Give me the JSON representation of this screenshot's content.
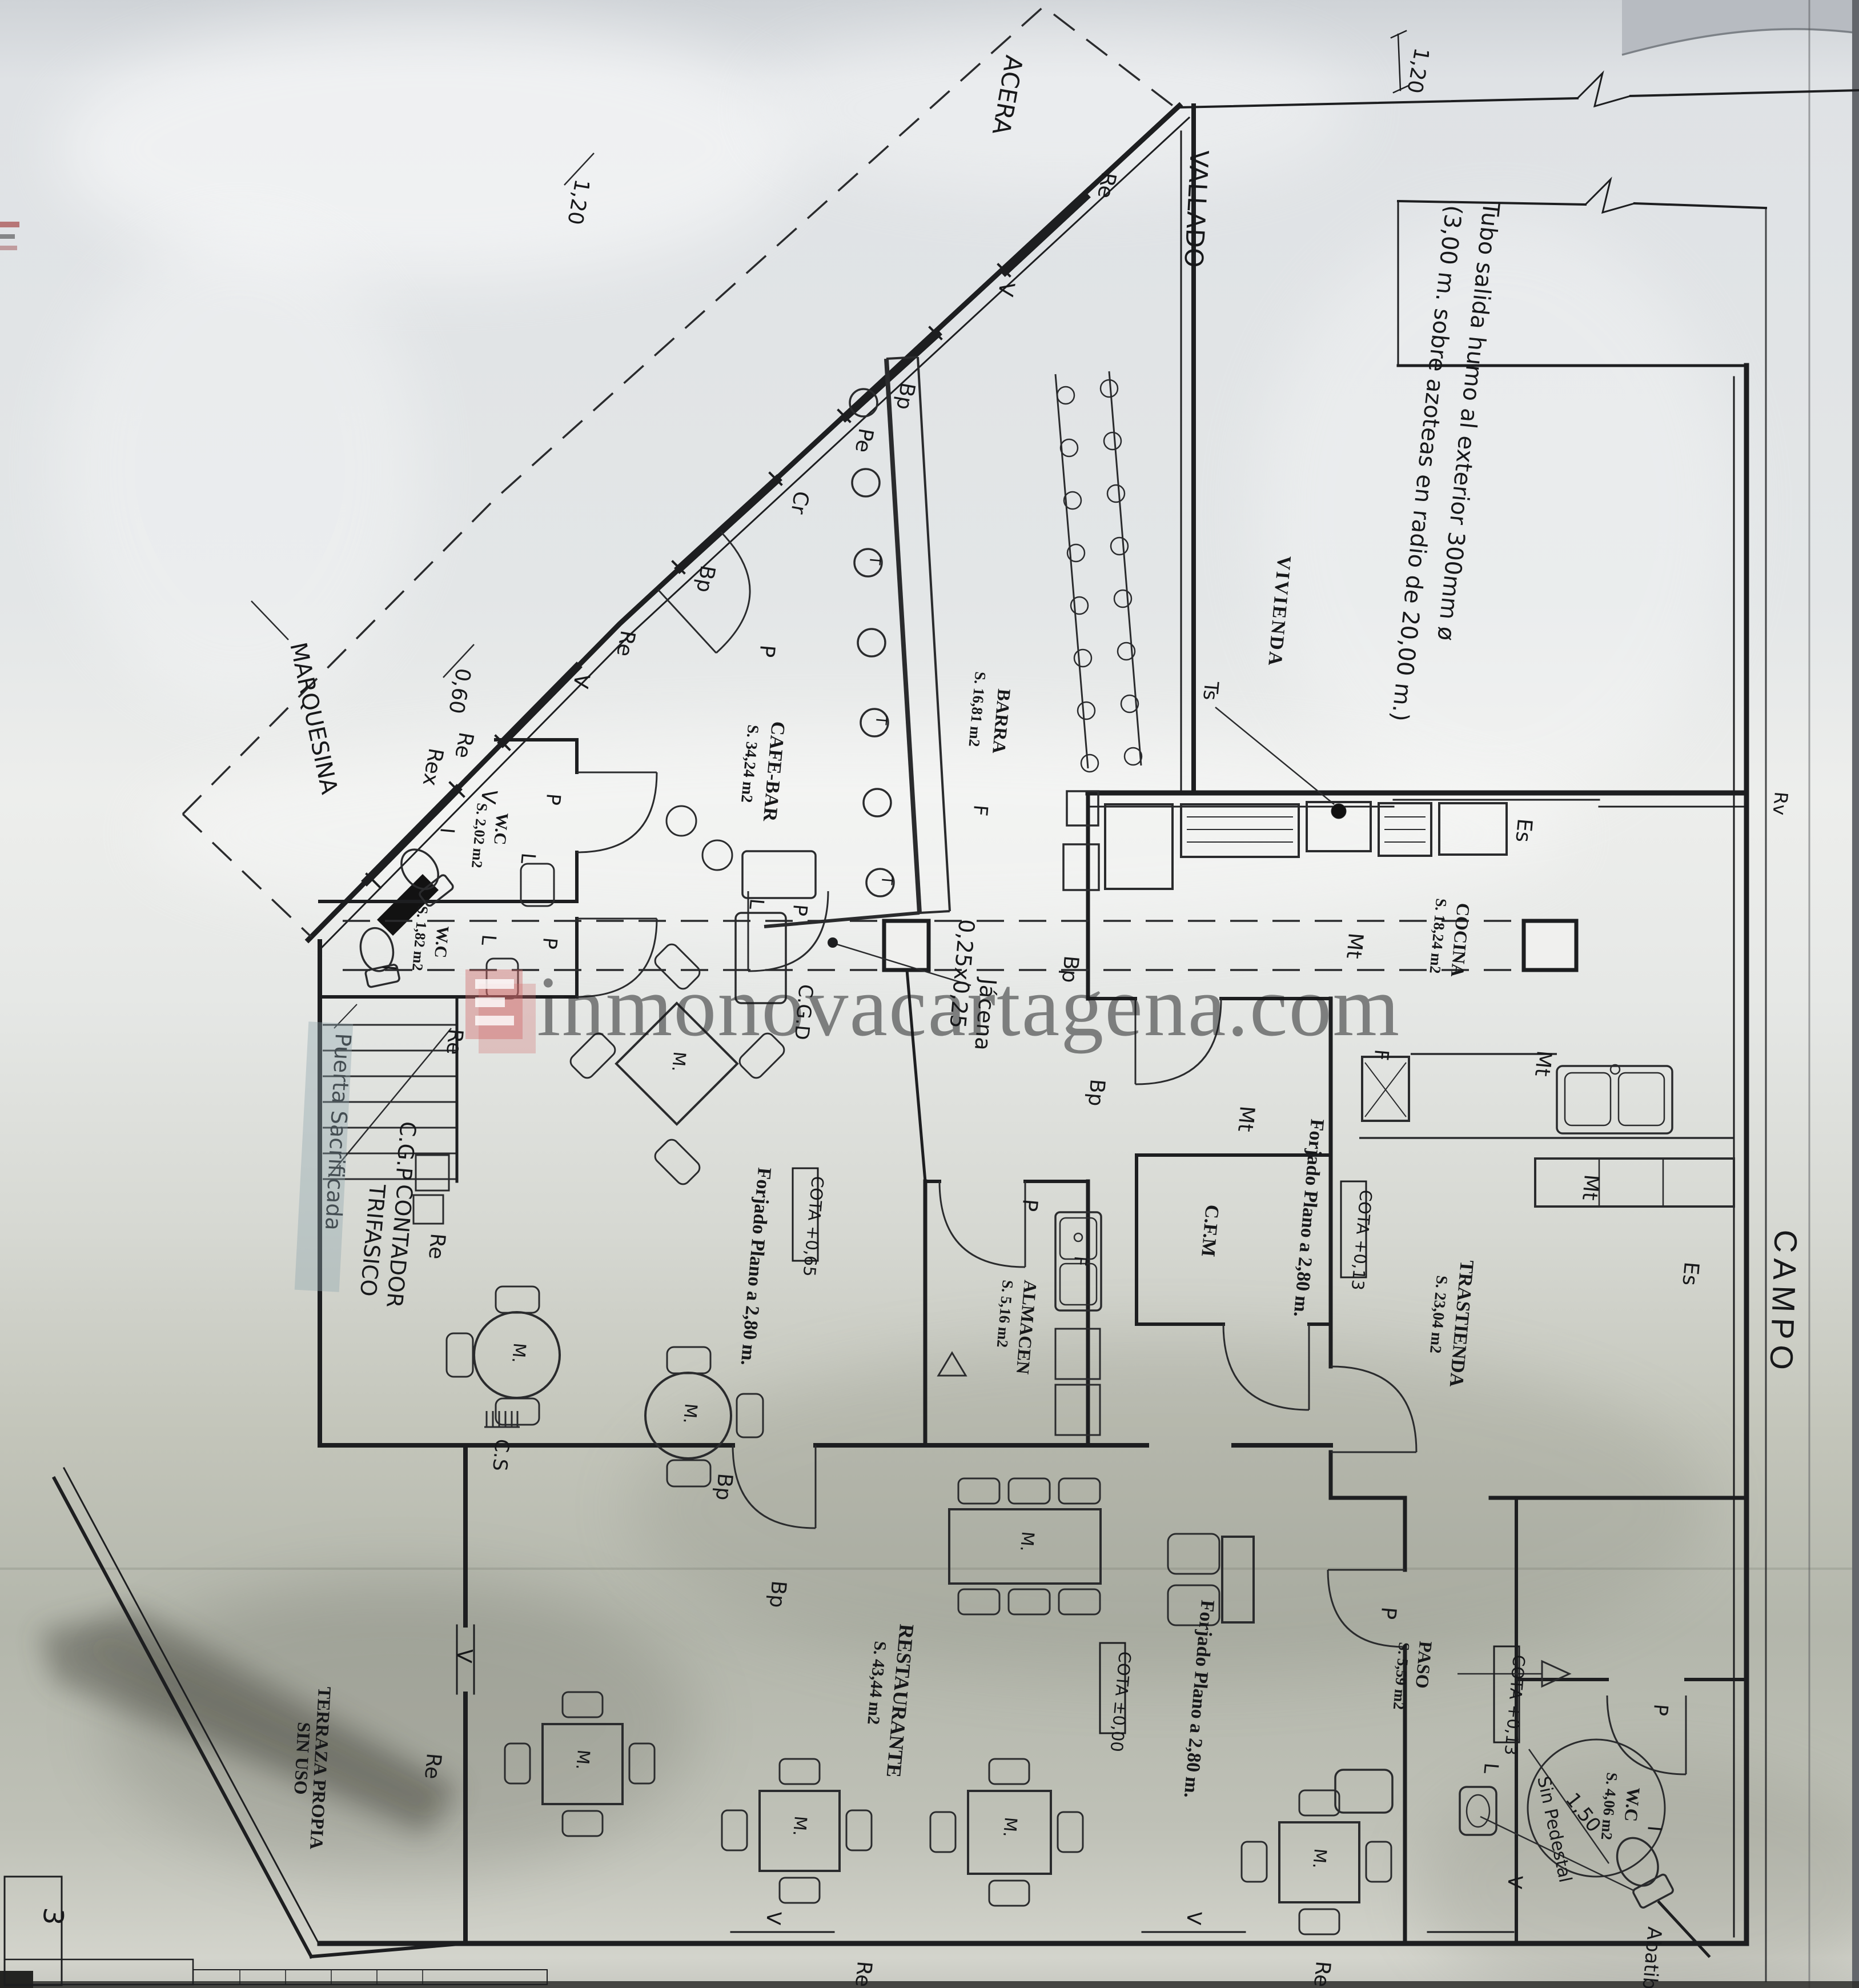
{
  "watermark": {
    "text": "inmonovacartagena.com",
    "logo_color": "#cf6a6a"
  },
  "colors": {
    "paper_light": "#e7e9ea",
    "paper_dark": "#b2b5aa",
    "ink": "#1d1e20",
    "highlight_marker": "#8fa6ad"
  },
  "rooms": {
    "cafe_bar": {
      "name": "CAFE-BAR",
      "area": "S. 34,24 m2"
    },
    "barra": {
      "name": "BARRA",
      "area": "S. 16,81 m2"
    },
    "cocina": {
      "name": "COCINA",
      "area": "S. 18,24 m2"
    },
    "trastienda": {
      "name": "TRASTIENDA",
      "area": "S. 23,04 m2"
    },
    "almacen": {
      "name": "ALMACEN",
      "area": "S. 5,16 m2"
    },
    "restaurante": {
      "name": "RESTAURANTE",
      "area": "S. 43,44 m2"
    },
    "paso": {
      "name": "PASO",
      "area": "S. 5,59 m2"
    },
    "wc1": {
      "name": "W.C",
      "area": "S. 2,02 m2"
    },
    "wc2": {
      "name": "W.C",
      "area": "S. 1,82 m2"
    },
    "wc3": {
      "name": "W.C",
      "area": "S. 4,06 m2",
      "note": "Sin Pedestal",
      "diameter": "1,50"
    },
    "cfm": {
      "name": "C.F.M"
    },
    "vivienda": {
      "name": "VIVIENDA"
    },
    "terraza": {
      "name": "TERRAZA PROPIA",
      "name2": "SIN USO"
    },
    "campo": {
      "name": "CAMPO"
    }
  },
  "notes": {
    "tubo_line1": "Tubo salida humo al exterior 300mm ø",
    "tubo_line2": "(3,00 m. sobre azoteas en radio de 20,00 m.)",
    "acera": "ACERA",
    "vallado": "VALLADO",
    "marquesina": "MARQUESINA",
    "puerta_sacrificada": "Puerta Sacrificada",
    "cgp": "C.G.P",
    "contador": "CONTADOR",
    "trifasico": "TRIFASICO",
    "cgd": "C.G.D",
    "cs": "C.S",
    "jacena": "Jácena",
    "jacena_size": "0,25x0,25",
    "forjado": "Forjado Plano a 2,80 m.",
    "cota_065": "COTA +0,65",
    "cota_013": "COTA +0,13",
    "cota_000": "COTA ±0,00",
    "abatible": "Abatible"
  },
  "dims": {
    "d120": "1,20",
    "d060": "0,60",
    "d150": "1,50",
    "corner_mark": "3"
  },
  "codes": {
    "re": "Re",
    "rex": "Rex",
    "v": "V",
    "p": "P",
    "bp": "Bp",
    "pe": "Pe",
    "cr": "Cr",
    "i": "I",
    "l": "L",
    "f": "F",
    "t": "T",
    "mt": "Mt",
    "es": "Es",
    "ts": "Ts",
    "rv": "Rv",
    "m": "M."
  }
}
